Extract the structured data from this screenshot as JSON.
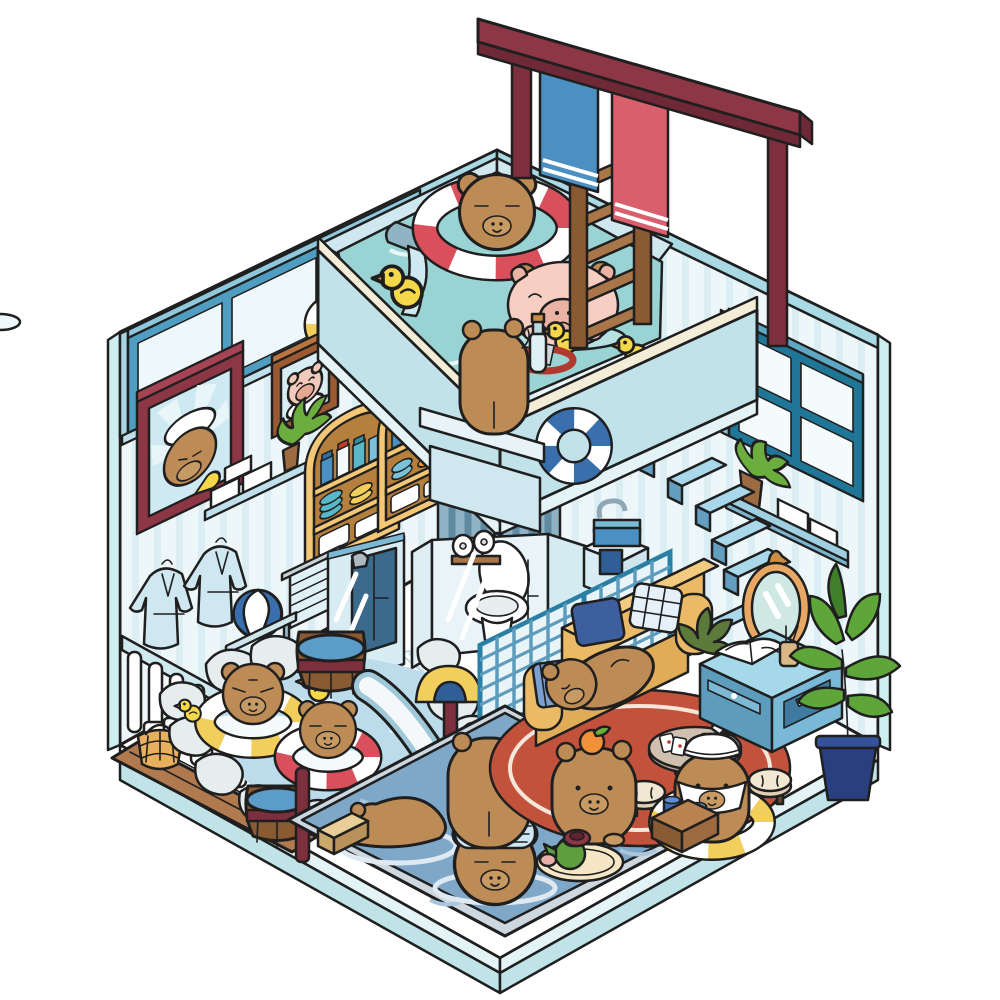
{
  "title": "Capybara Bathhouse — Isometric Cutaway Illustration",
  "alt": "Cutaway isometric cartoon of a two-story capybara bathhouse: rooftop pool with swim rings and ladder, glass bathroom with toilet, rock onsen hot spring, lounge with yellow sofa, and a big soaking pool full of capybaras",
  "colors": {
    "outline": "#1f1f1f",
    "wall": "#edf6f8",
    "wallStripe": "#cbe6ee",
    "wallTrim": "#a9d9e2",
    "wallOuter": "#cdeef0",
    "floor": "#ffffff",
    "slabLight": "#e4f3f5",
    "slabDark": "#bfe3e6",
    "rooftopWater": "#9ad3d4",
    "poolWater": "#7fa8c8",
    "onsenWater": "#bcdcec",
    "poolRim": "#ccd7df",
    "parapet": "#c2e2ea",
    "parapetTrim": "#f3ecd7",
    "ledge": "#cfe7ee",
    "capybara": "#bd8b55",
    "capybaraDark": "#9c6b3a",
    "muzzle": "#c79a63",
    "ringRed": "#d94f5c",
    "ringYellow": "#f2cf5c",
    "ringBlue": "#3a6fae",
    "floatPink": "#f6cfc2",
    "floatPinkDark": "#eab3a4",
    "duck": "#f5d84a",
    "duckBeak": "#e08a2e",
    "maroon": "#8c3646",
    "maroonDark": "#6e2836",
    "post": "#7e2f3e",
    "woodLight": "#b9834f",
    "wood": "#9c6b42",
    "woodDark": "#8a5a33",
    "deck": "#b07a4e",
    "cabinetGold": "#f3c776",
    "cabinetInner": "#b5803d",
    "frameBlue": "#4f9ec2",
    "windowTeal": "#1f7697",
    "glass": "#e4f3f7",
    "glassFrame": "#7db9d4",
    "towelBlue": "#4a90c2",
    "towelRed": "#d95f6c",
    "sofa": "#eaba66",
    "sofaDark": "#e0ac58",
    "pillowNavy": "#3e5f9e",
    "pillowPlaid": "#e6f0f8",
    "tableBlue": "#a5d8e8",
    "tableBlueDark": "#5e9cbd",
    "tableBlueMid": "#79b8d6",
    "rug": "#c2523c",
    "stool": "#f2e7d2",
    "stoolSide": "#e0d0b4",
    "rock": "#e6edee",
    "rockShade": "#c9d6da",
    "plantGreen": "#6cae3e",
    "plantDark": "#3f7f2a",
    "potNavy": "#2a3f7e",
    "teapot": "#5e9e3e",
    "tray": "#f5e7c6",
    "mirror": "#e8a864",
    "mirrorGlass": "#cfe8e4",
    "shower": "#3b6a8c",
    "basin": "#4a90c2",
    "fence": "#cfe9ee",
    "lattice": "#5e9cbd",
    "latticeFill": "#e8f4f8",
    "steel": "#8fb5c4",
    "orange": "#f0913a"
  },
  "scene": {
    "areas": [
      "rooftop-pool",
      "towel-sign-rack",
      "upper-left-wall",
      "upper-right-wall",
      "glass-bathroom",
      "shower-cabin",
      "onsen-hot-spring",
      "wood-deck",
      "lounge-living-area",
      "soaking-pool",
      "diving-balcony"
    ],
    "characters": [
      "capybara-in-red-swim-ring",
      "capybara-in-pink-pig-float",
      "capybara-standing-on-balcony",
      "capybara-in-yellow-ring-onsen",
      "capybara-in-red-ring-onsen",
      "capybara-sleeping-on-sofa",
      "capybara-with-orange-on-head",
      "capybara-with-sailor-towel-cap",
      "capybara-standing-at-pool-edge",
      "capybara-lying-in-pool",
      "capybara-towel-head-soaking",
      "capybara-back-soaking"
    ],
    "props": [
      "wooden-ladder",
      "hanging-towels-blue-red",
      "water-spout",
      "rubber-ducks",
      "swim-rings-on-wall",
      "framed-capybara-pictures",
      "arched-jar-cabinets",
      "bathrobes",
      "towel-rail",
      "beach-ball",
      "white-fence",
      "wooden-barrels",
      "wicker-basket",
      "incense-cup",
      "water-slide",
      "toilet",
      "toilet-paper",
      "wash-basin",
      "lattice-screens",
      "floating-wall-steps",
      "oval-mirror",
      "wall-shelves-with-boxes",
      "potted-plants",
      "yellow-sofa",
      "pillows",
      "coffee-table-with-book",
      "red-round-rug",
      "round-table-with-cards",
      "cream-stools",
      "tea-tray-with-teapot",
      "crate-with-cups",
      "pet-dome-bed"
    ]
  }
}
